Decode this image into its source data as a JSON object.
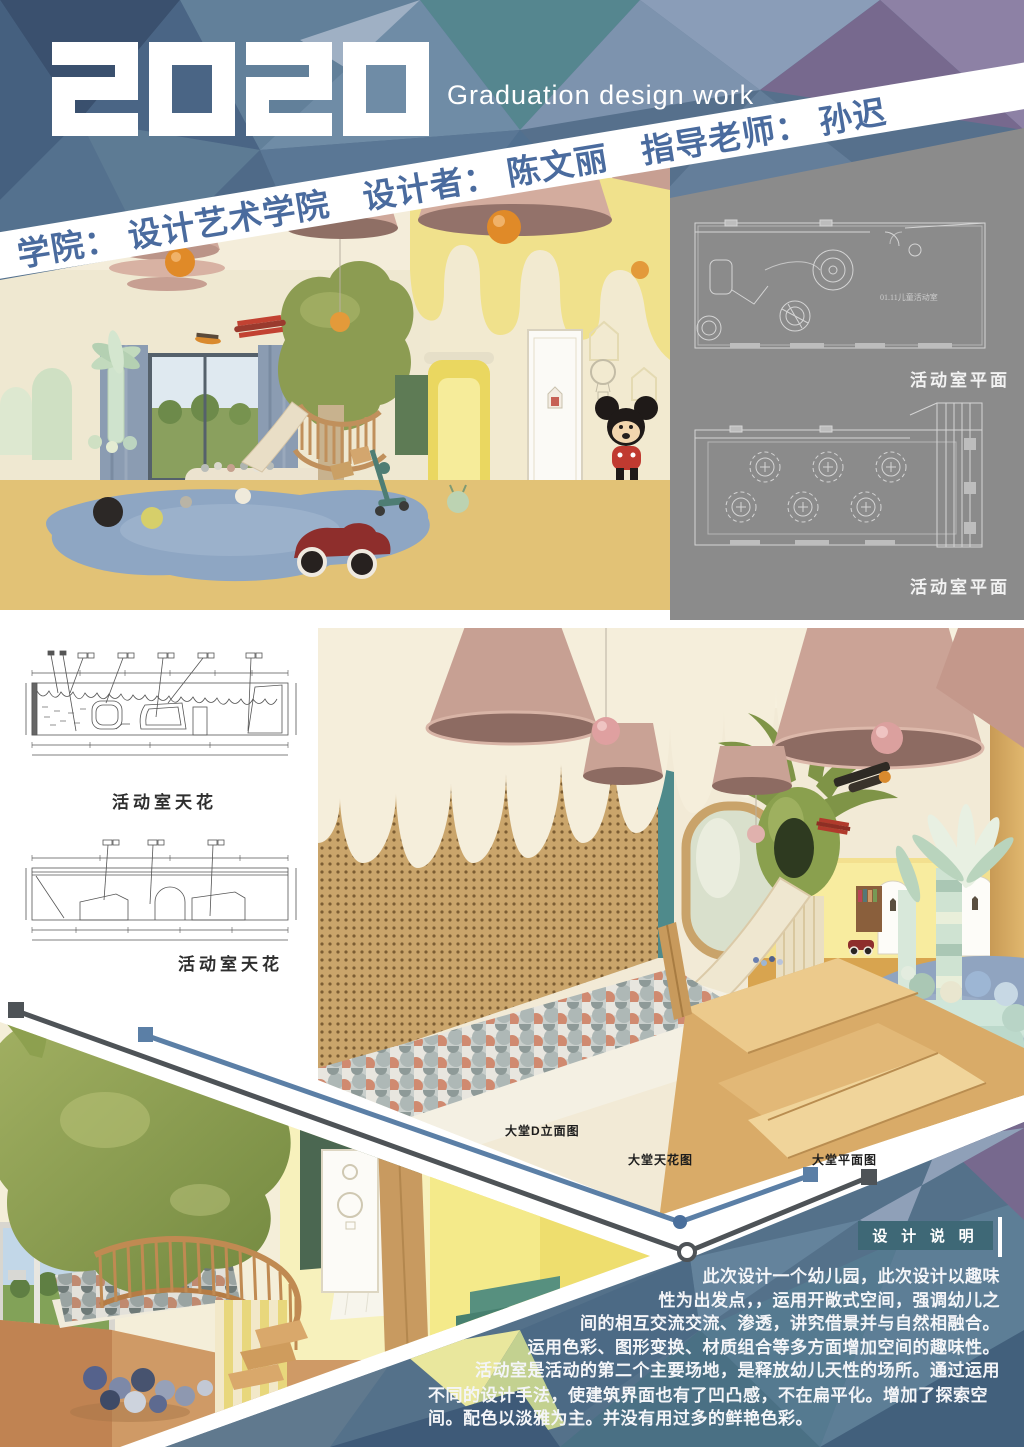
{
  "poster": {
    "year": "2020",
    "subtitle": "Graduation design work",
    "credits": {
      "college": "学院：  设计艺术学院",
      "designer": "设计者：  陈文丽",
      "advisor": "指导老师：  孙迟"
    }
  },
  "gray_panel": {
    "plan1": {
      "room_label": "01.11儿童活动室",
      "caption": "活动室平面"
    },
    "plan2": {
      "caption": "活动室平面"
    }
  },
  "drawings": {
    "elevation1_caption": "活动室天花",
    "elevation2_caption": "活动室天花"
  },
  "hall_labels": {
    "elevation": "大堂D立面图",
    "ceiling": "大堂天花图",
    "plan": "大堂平面图"
  },
  "description": {
    "title": "设 计 说 明",
    "lines": [
      "此次设计一个幼儿园，此次设计以趣味",
      "性为出发点，，运用开敞式空间，强调幼儿之",
      "间的相互交流交流、渗透，讲究借景并与自然相融合。",
      "运用色彩、图形变换、材质组合等多方面增加空间的趣味性。",
      "活动室是活动的第二个主要场地，是释放幼儿天性的场所。通过运用",
      "不同的设计手法，使建筑界面也有了凹凸感，不在扁平化。增加了探索空",
      "间。配色以淡雅为主。并没有用过多的鲜艳色彩。"
    ]
  },
  "colors": {
    "accent_text": "#4a6b9e",
    "description_box": "#3e6876",
    "panel_gray": "#8b8b8b",
    "connector_blue": "#5b7fa6",
    "connector_dark": "#4e5357"
  }
}
